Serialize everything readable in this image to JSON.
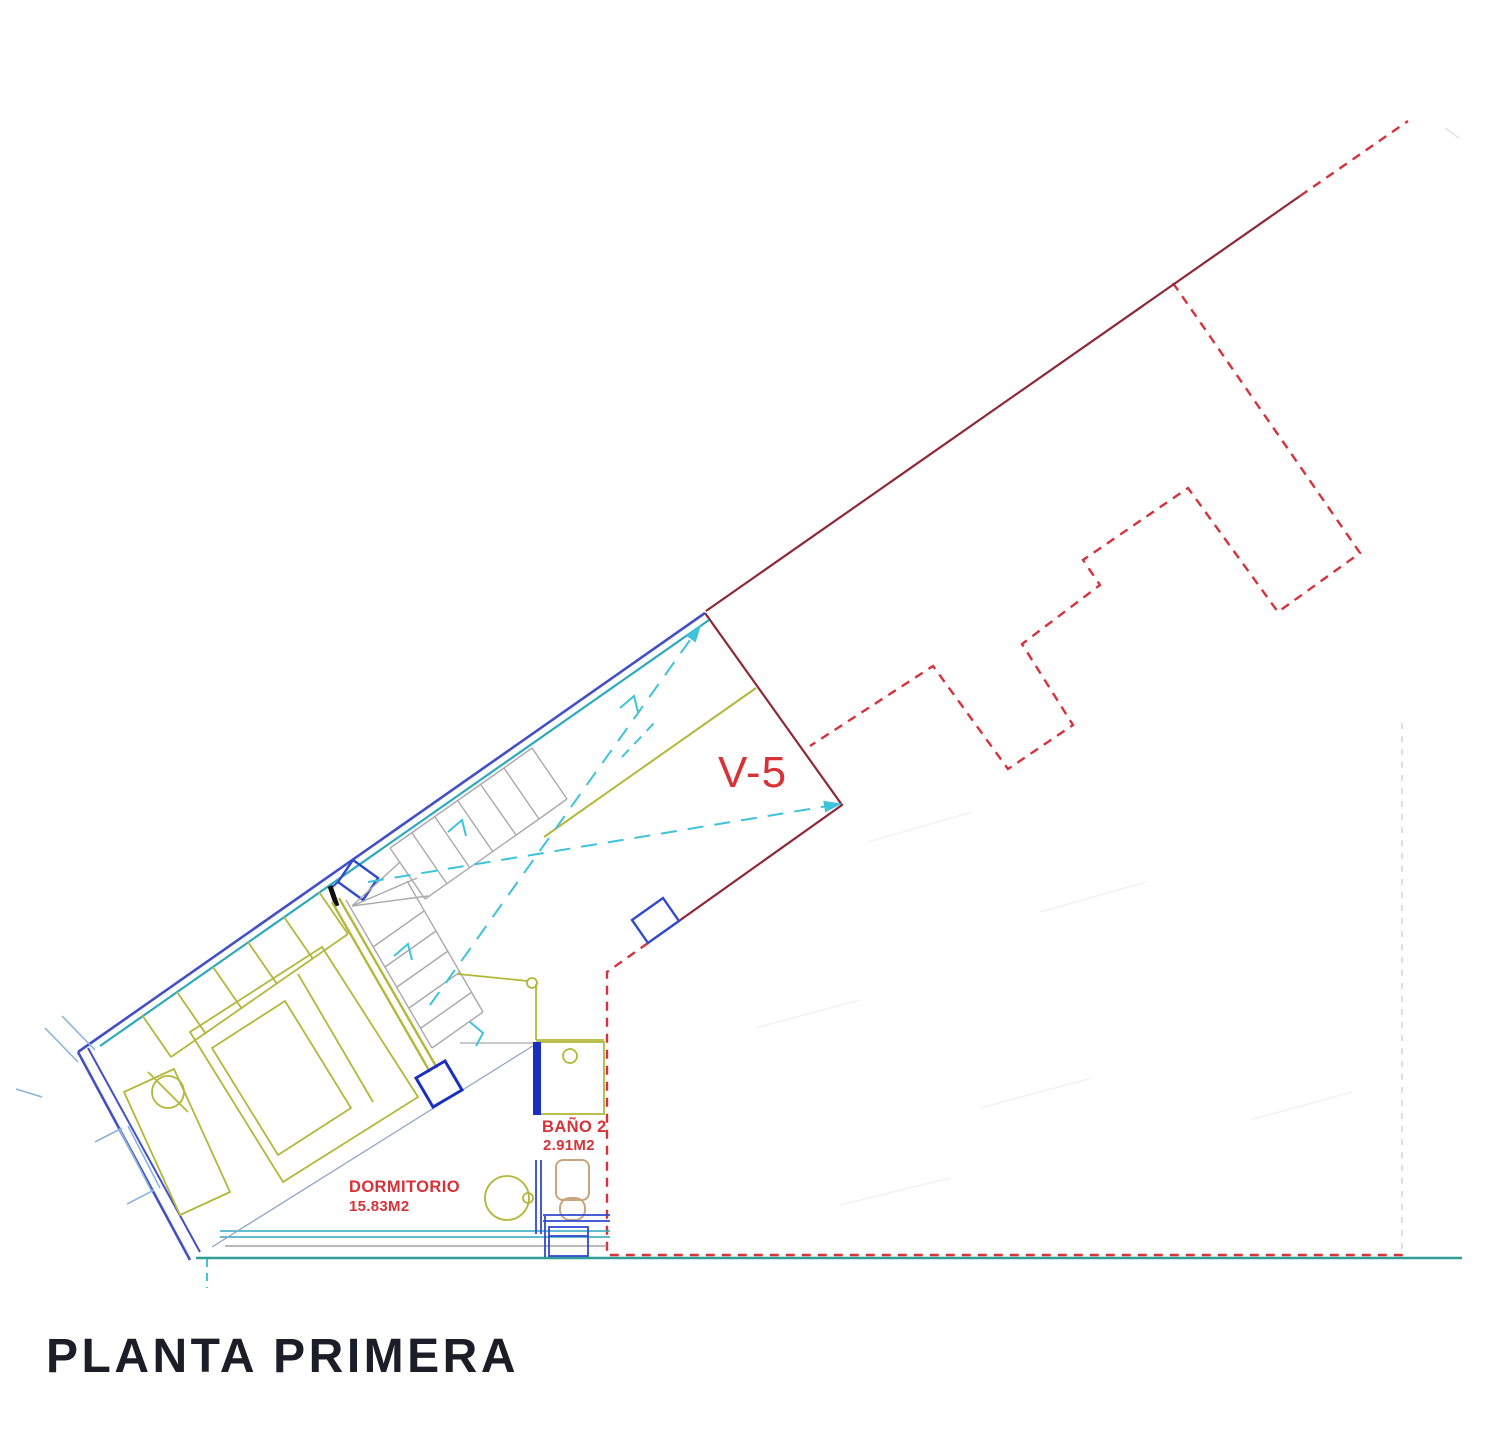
{
  "drawing": {
    "title": "PLANTA PRIMERA",
    "window_label": "V-5",
    "rooms": {
      "bathroom": {
        "name": "BAÑO 2",
        "area": "2.91M2"
      },
      "bedroom": {
        "name": "DORMITORIO",
        "area": "15.83M2"
      }
    }
  },
  "colors": {
    "red_dash": "#d5333c",
    "maroon": "#8e2838",
    "label_red": "#d63238",
    "indigo_wall": "#4350c5",
    "door_blue": "#2f49cf",
    "deep_blue": "#1b2fc0",
    "teal_wall": "#2ea9bc",
    "light_blue": "#8cb4de",
    "slate": "#90a7c9",
    "olive": "#b3b73a",
    "gray_stair": "#a9a9ad",
    "cyan": "#3fc3da",
    "tan": "#c9a57e",
    "terrace_teal": "#2f9e93",
    "thin_maroon": "#9b8e8e",
    "faint": "#aab0bd",
    "title_color": "#1d1d28"
  }
}
